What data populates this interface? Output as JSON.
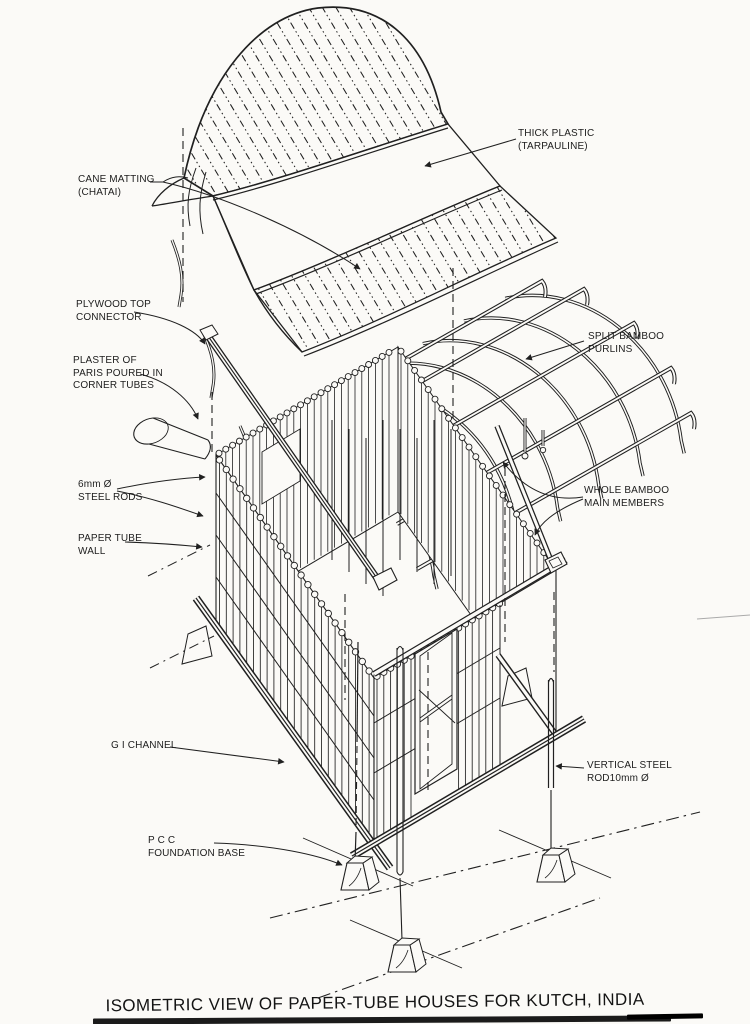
{
  "title": "ISOMETRIC VIEW OF PAPER-TUBE HOUSES FOR KUTCH, INDIA",
  "labels": {
    "cane_matting": "CANE MATTING\n(CHATAI)",
    "thick_plastic": "THICK PLASTIC\n(TARPAULINE)",
    "plywood_top_connector": "PLYWOOD TOP\nCONNECTOR",
    "plaster_of_paris": "PLASTER OF\nPARIS POURED IN\nCORNER TUBES",
    "steel_rods_6mm": "6mm Ø\nSTEEL RODS",
    "paper_tube_wall": "PAPER TUBE\nWALL",
    "split_bamboo_purlins": "SPLIT BAMBOO\nPURLINS",
    "whole_bamboo_main_members": "WHOLE BAMBOO\nMAIN MEMBERS",
    "gi_channel": "G I CHANNEL",
    "vertical_steel_rod": "VERTICAL STEEL\nROD10mm Ø",
    "pcc_foundation_base": "P C C\nFOUNDATION BASE"
  },
  "colors": {
    "ink": "#202020",
    "paper": "#fbfaf7",
    "scan_bar": "#1b1b1b"
  }
}
